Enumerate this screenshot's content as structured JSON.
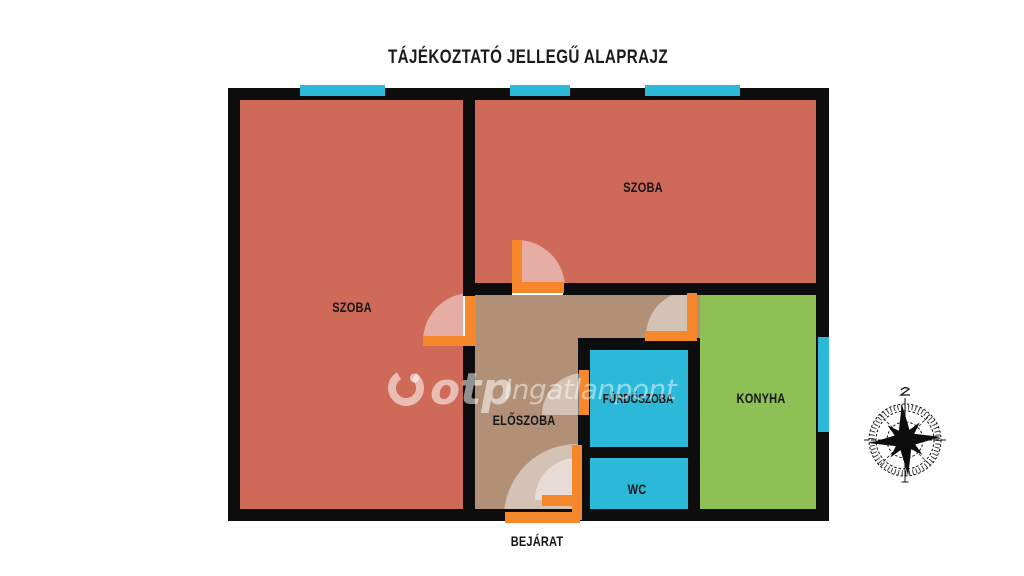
{
  "title": "TÁJÉKOZTATÓ JELLEGŰ ALAPRAJZ",
  "rooms": {
    "szoba_left": "SZOBA",
    "szoba_right": "SZOBA",
    "eloszoba": "ELŐSZOBA",
    "furdoszoba": "FÜRDŐSZOBA",
    "wc": "WC",
    "konyha": "KONYHA"
  },
  "entrance_label": "BEJÁRAT",
  "watermark": {
    "brand": "otp",
    "name": "Ingatlanpont"
  },
  "colors": {
    "room": "#cf6a59",
    "hall": "#b19077",
    "wet_room": "#2cb9d9",
    "kitchen": "#8fc055",
    "door": "#f6872b",
    "window": "#2cb9d9",
    "wall": "#0d0d0d",
    "swing": "rgba(255,255,255,0.45)"
  }
}
